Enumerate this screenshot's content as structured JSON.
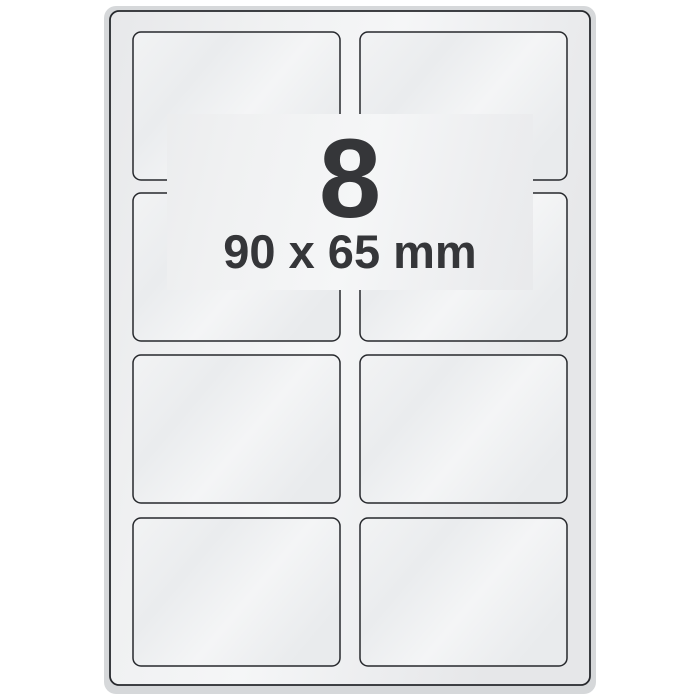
{
  "sheet": {
    "count": "8",
    "size": "90 x 65 mm",
    "layout": {
      "total_labels": 8,
      "columns": 2,
      "rows": 4
    },
    "colors": {
      "background": "#ffffff",
      "page_edge": "#d6d8da",
      "page_fill_light": "#f5f6f7",
      "page_fill_dark": "#e6e7e9",
      "label_fill_light": "#f4f5f6",
      "label_fill_dark": "#e9ebed",
      "outline": "#26282c",
      "text": "#353639"
    }
  }
}
